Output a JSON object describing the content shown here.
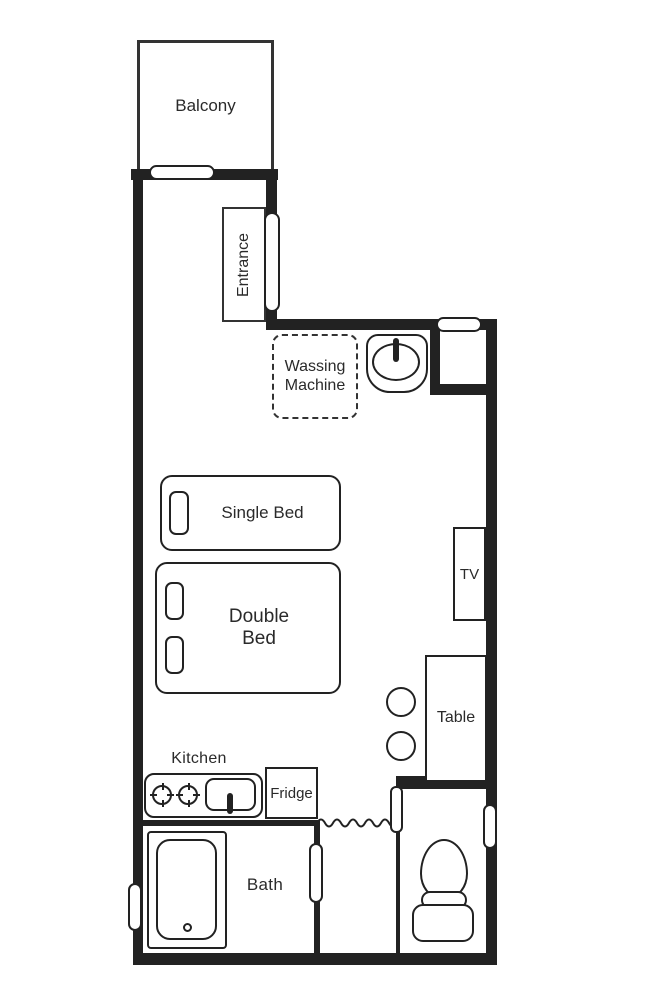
{
  "colors": {
    "line": "#222222",
    "background": "#ffffff"
  },
  "rooms": {
    "balcony": {
      "label": "Balcony"
    },
    "entrance": {
      "label": "Entrance"
    },
    "kitchen": {
      "label": "Kitchen"
    },
    "bath": {
      "label": "Bath"
    }
  },
  "furniture": {
    "washing_machine": {
      "line1": "Wassing",
      "line2": "Machine"
    },
    "single_bed": {
      "label": "Single Bed"
    },
    "double_bed": {
      "line1": "Double",
      "line2": "Bed"
    },
    "tv": {
      "label": "TV"
    },
    "table": {
      "label": "Table"
    },
    "fridge": {
      "label": "Fridge"
    }
  },
  "fixtures": {
    "balcony_door": "sliding-door-opening",
    "entrance_door": "door-opening",
    "niche_window": "wall-opening",
    "wash_basin": "basin-with-tap",
    "stove": "two-burner-stove",
    "kitchen_sink": "sink-with-tap",
    "chairs": "round-stool",
    "shower_curtain": "wavy-curtain",
    "bathtub": "bathtub-with-drain",
    "bath_door": "door-opening",
    "bath_window": "wall-opening",
    "toilet": "toilet-with-tank",
    "toilet_door": "door-opening",
    "toilet_window": "wall-opening"
  }
}
